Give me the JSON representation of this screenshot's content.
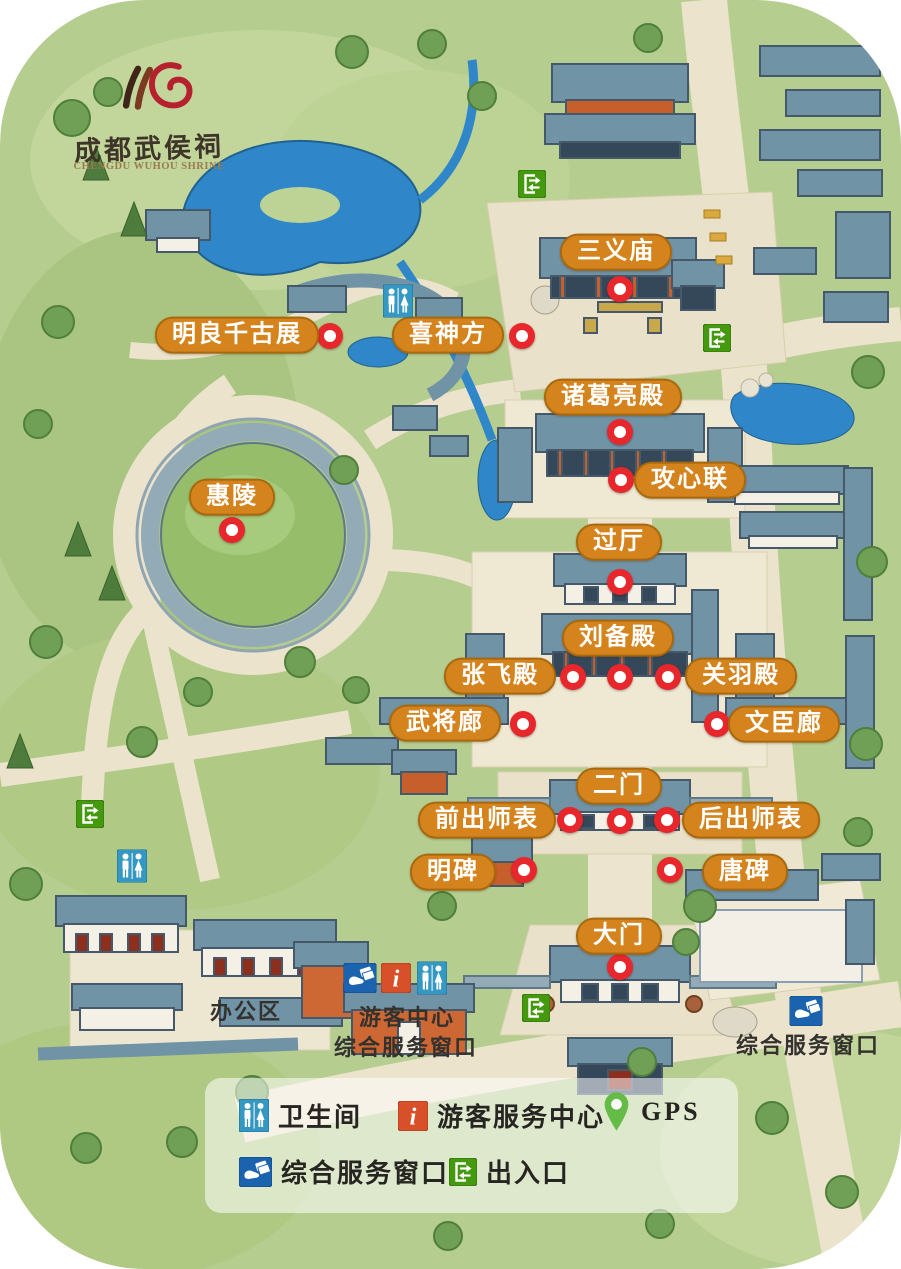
{
  "logo": {
    "chinese": "成都武侯祠",
    "english": "CHENGDU WUHOU SHRINE"
  },
  "map": {
    "pois": [
      {
        "label": "三义庙",
        "x": 616,
        "y": 252,
        "mx": 620,
        "my": 289
      },
      {
        "label": "明良千古展",
        "x": 237,
        "y": 335,
        "mx": 330,
        "my": 336
      },
      {
        "label": "喜神方",
        "x": 448,
        "y": 335,
        "mx": 522,
        "my": 336
      },
      {
        "label": "诸葛亮殿",
        "x": 613,
        "y": 397,
        "mx": 620,
        "my": 432
      },
      {
        "label": "攻心联",
        "x": 690,
        "y": 480,
        "mx": 621,
        "my": 480
      },
      {
        "label": "惠陵",
        "x": 232,
        "y": 497,
        "mx": 232,
        "my": 530
      },
      {
        "label": "过厅",
        "x": 619,
        "y": 542,
        "mx": 620,
        "my": 582
      },
      {
        "label": "刘备殿",
        "x": 618,
        "y": 638,
        "mx": 620,
        "my": 677
      },
      {
        "label": "张飞殿",
        "x": 500,
        "y": 676,
        "mx": 573,
        "my": 677
      },
      {
        "label": "关羽殿",
        "x": 741,
        "y": 676,
        "mx": 668,
        "my": 677
      },
      {
        "label": "武将廊",
        "x": 445,
        "y": 723,
        "mx": 523,
        "my": 724
      },
      {
        "label": "文臣廊",
        "x": 784,
        "y": 724,
        "mx": 717,
        "my": 724
      },
      {
        "label": "二门",
        "x": 619,
        "y": 786,
        "mx": 620,
        "my": 821
      },
      {
        "label": "前出师表",
        "x": 487,
        "y": 820,
        "mx": 570,
        "my": 820
      },
      {
        "label": "后出师表",
        "x": 751,
        "y": 820,
        "mx": 667,
        "my": 820
      },
      {
        "label": "明碑",
        "x": 453,
        "y": 872,
        "mx": 524,
        "my": 870
      },
      {
        "label": "唐碑",
        "x": 745,
        "y": 872,
        "mx": 670,
        "my": 870
      },
      {
        "label": "大门",
        "x": 619,
        "y": 936,
        "mx": 620,
        "my": 967
      }
    ],
    "icons": [
      {
        "type": "exit",
        "x": 532,
        "y": 184
      },
      {
        "type": "toilet",
        "x": 398,
        "y": 301
      },
      {
        "type": "exit",
        "x": 717,
        "y": 338
      },
      {
        "type": "exit",
        "x": 90,
        "y": 814
      },
      {
        "type": "toilet",
        "x": 132,
        "y": 866
      },
      {
        "type": "service",
        "x": 360,
        "y": 978
      },
      {
        "type": "info",
        "x": 396,
        "y": 978
      },
      {
        "type": "toilet",
        "x": 432,
        "y": 978
      },
      {
        "type": "exit",
        "x": 536,
        "y": 1008
      },
      {
        "type": "service",
        "x": 806,
        "y": 1011
      }
    ],
    "area_labels": [
      {
        "text": "办公区",
        "x": 246,
        "y": 1010
      },
      {
        "text": "游客中心",
        "x": 407,
        "y": 1016
      },
      {
        "text": "综合服务窗口",
        "x": 406,
        "y": 1046
      },
      {
        "text": "综合服务窗口",
        "x": 808,
        "y": 1044
      }
    ]
  },
  "legend": {
    "items": [
      {
        "icon": "toilet",
        "label": "卫生间"
      },
      {
        "icon": "info",
        "label": "游客服务中心"
      },
      {
        "icon": "gps",
        "label": "GPS"
      },
      {
        "icon": "service",
        "label": "综合服务窗口"
      },
      {
        "icon": "exit",
        "label": "出入口"
      }
    ]
  },
  "colors": {
    "pill": "#d5831c",
    "pill_border": "#a8690e",
    "marker_red": "#e8272d",
    "exit_green": "#44990e",
    "toilet_blue": "#3598c2",
    "info_orange": "#d8502a",
    "service_blue": "#1b63ae",
    "gps_green": "#64bb46",
    "logo_red": "#b5212c",
    "grass_green": "#b6cd90",
    "path_beige": "#ece4ce",
    "water_blue": "#2f86c8"
  }
}
